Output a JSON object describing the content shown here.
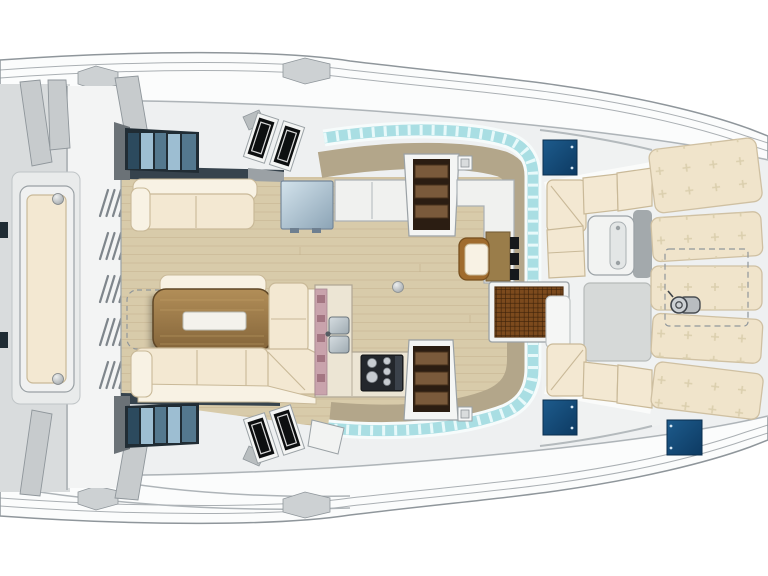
{
  "plan": {
    "type": "catamaran-interior-deck-plan",
    "view": "top-down",
    "areas": [
      {
        "name": "aft-deck",
        "items": [
          "bench-seat",
          "deck-vents",
          "support-braces",
          "crossbeam"
        ]
      },
      {
        "name": "saloon",
        "items": [
          "sofa",
          "dining-table",
          "u-shaped-sofa",
          "table-extension-outline",
          "galley-counter",
          "double-sink",
          "stove",
          "refrigerator",
          "sideboard",
          "navigation-desk",
          "navigation-seat",
          "instrument-panel",
          "port-hull-stairs",
          "starboard-hull-stairs",
          "side-windows",
          "opening-hatches",
          "windshield-glazing",
          "dashboard",
          "deck-light-port",
          "deck-light-starboard",
          "table-leg-socket"
        ]
      },
      {
        "name": "forward-cockpit",
        "items": [
          "bench-port",
          "bench-starboard",
          "cockpit-table",
          "entry-grate",
          "floor-hatch-panel"
        ]
      },
      {
        "name": "foredeck",
        "items": [
          "sunpads",
          "storage-locker-outline",
          "windlass",
          "deck-hatches"
        ]
      }
    ],
    "counts": {
      "sunpads": 5,
      "deck_hatches": 3,
      "vent_groups": 5,
      "hull_stairs": 2,
      "angled_hatch_pairs": 2,
      "stove_burners": 5,
      "sink_basins": 2
    }
  },
  "colors": {
    "bg": "#ffffff",
    "hull": "#fbfcfc",
    "hullLine": "#8f969b",
    "deckBand": "#eef0f1",
    "deckLine": "#aeb4b8",
    "grayPanel": "#d9dcdd",
    "brace": "#c7cbcd",
    "wood": "#d8cbaa",
    "woodLine": "#c3b28d",
    "navyBand": "#36434d",
    "winFrame": "#202c34",
    "paneL": "#9dbed2",
    "paneM": "#54788e",
    "paneD": "#2c4a5e",
    "cream": "#f3e8d2",
    "creamLight": "#f8f2e4",
    "creamLine": "#c9b998",
    "fridgeA": "#d3e3ec",
    "fridgeB": "#8ca4b6",
    "counter": "#f0f1ef",
    "counterLine": "#a9b0b5",
    "stairPit": "#2b1d12",
    "stairStep": "#7a5a3b",
    "stairLine": "#46301b",
    "khaki": "#b3a68a",
    "aqua": "#a9dee3",
    "aquaHi": "#e8f9fa",
    "whiteTrim": "#f6fbfb",
    "desk": "#9a7d4a",
    "deskLine": "#77603a",
    "seatWood": "#a06c2e",
    "seatWoodLine": "#77501f",
    "tableA": "#b28e58",
    "tableB": "#84653a",
    "tableLine": "#5e4626",
    "inlay": "#f4f2ec",
    "inlayLine": "#b9bab2",
    "pink": "#c9a3ac",
    "pinkDot": "#9b6b78",
    "sink": "#9fabb2",
    "sinkHi": "#d6dde1",
    "sinkLine": "#6c767d",
    "stove": "#23272c",
    "burner": "#c7ccd1",
    "grate": "#7c4a1d",
    "grateLine": "#3a2008",
    "hatchA": "#1d5b8c",
    "hatchB": "#0d3a62",
    "hatchDot": "#d7e8f4",
    "sunpad": "#f0e4cb",
    "sunpadLine": "#cfc0a2",
    "tuft": "#dbcfae",
    "cockpitFloor": "#f0f2f2",
    "grayHatch": "#d6d9d8",
    "grayHatchLine": "#b6bab9",
    "tableWhite": "#f2f3f2",
    "tableWhiteLine": "#9ca3a7",
    "shadowStrip": "#90969a",
    "iconGray": "#9aa1a5",
    "ball": "#9aa0a4",
    "ballHi": "#eceeee",
    "instrument": "#15181b"
  }
}
